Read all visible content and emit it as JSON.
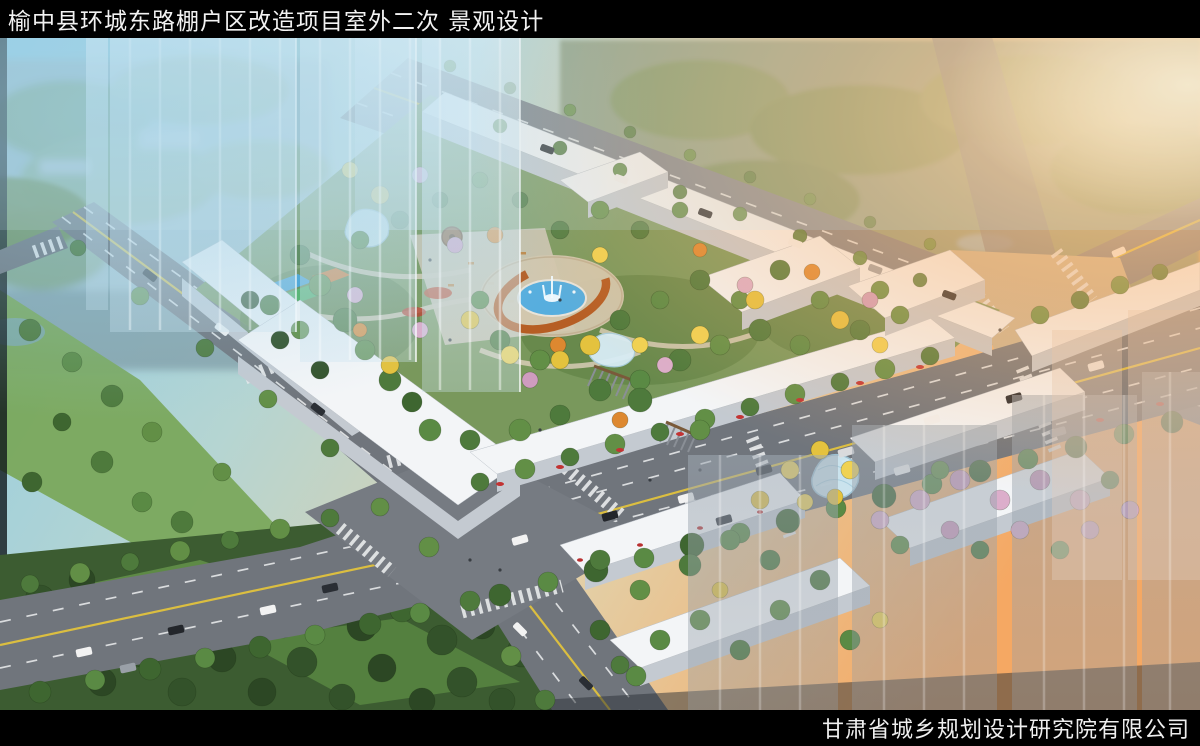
{
  "header": {
    "title": "榆中县环城东路棚户区改造项目室外二次 景观设计"
  },
  "footer": {
    "company": "甘肃省城乡规划设计研究院有限公司"
  },
  "palette": {
    "frame_black": "#000000",
    "title_text": "#f2f2f2",
    "sky_cool_blue": "#8ecbe4",
    "sunset_orange": "#f5a863",
    "road_gray": "#70757c",
    "building_white": "#f3f5f7",
    "foliage_green": "#4e7a3c",
    "autumn_yellow": "#e4c23e",
    "blossom_pink": "#dcaecb",
    "fountain_blue": "#57aede",
    "pergola_rust": "#b4591c"
  }
}
